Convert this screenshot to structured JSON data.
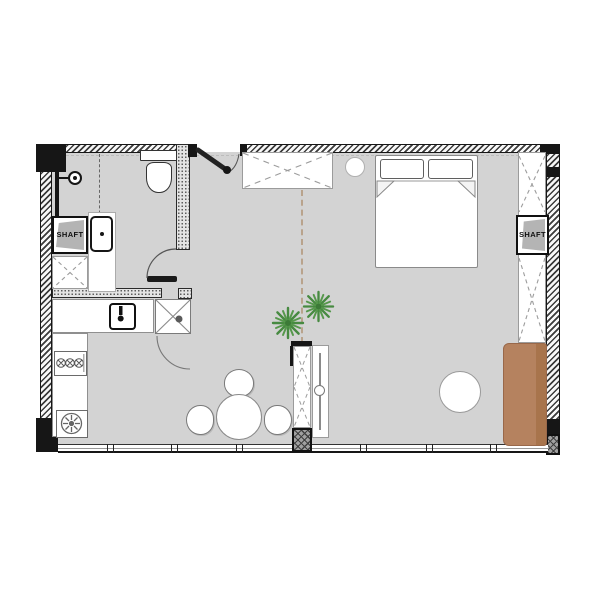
{
  "plan": {
    "labels": {
      "shaft_left": "SHAFT",
      "shaft_right": "SHAFT"
    },
    "colors": {
      "background": "#ffffff",
      "floor": "#d3d3d3",
      "walls": "#161616",
      "sofa": "#b5825f",
      "sofa_back": "#a8744c",
      "plants": "#478a41",
      "ceiling_dash_line": "#b9a38c"
    },
    "symbols": [
      "entry-door",
      "wardrobe",
      "pendant-light",
      "double-bed",
      "pillows",
      "closet-right",
      "shaft-right",
      "sofa",
      "side-table",
      "room-divider",
      "tv-panel",
      "plants",
      "dining-table",
      "dining-chairs",
      "kitchen-sink",
      "appliance-box",
      "stove",
      "washing-machine",
      "kitchen-counter",
      "shaft-left",
      "closet-left",
      "vanity-sink",
      "toilet",
      "shower",
      "bathroom-door",
      "window-wall"
    ]
  }
}
